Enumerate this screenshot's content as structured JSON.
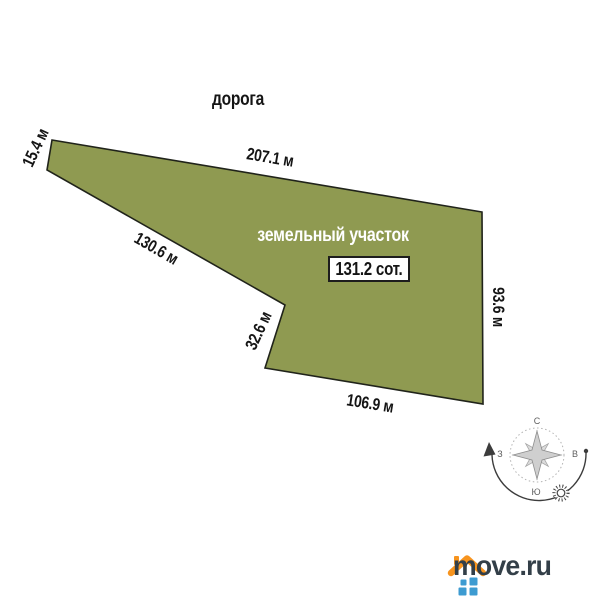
{
  "road_label": "дорога",
  "plot": {
    "label": "земельный участок",
    "area_label": "131.2 сот.",
    "dimensions": {
      "left_side": "15.4 м",
      "top_side": "207.1 м",
      "diagonal_side": "130.6 м",
      "notch_side": "32.6 м",
      "right_side": "93.6 м",
      "bottom_side": "106.9 м"
    }
  },
  "compass": {
    "north": "С",
    "east": "В",
    "south": "Ю",
    "west": "З"
  },
  "logo": {
    "text": "move.ru"
  },
  "colors": {
    "plot_fill": "#8f9a51",
    "plot_border": "#20231a",
    "label_text": "#151515",
    "plot_label_text": "#ffffff",
    "logo_text": "#333f48",
    "logo_roof": "#f7941e",
    "logo_windows": "#3d9bd1"
  }
}
